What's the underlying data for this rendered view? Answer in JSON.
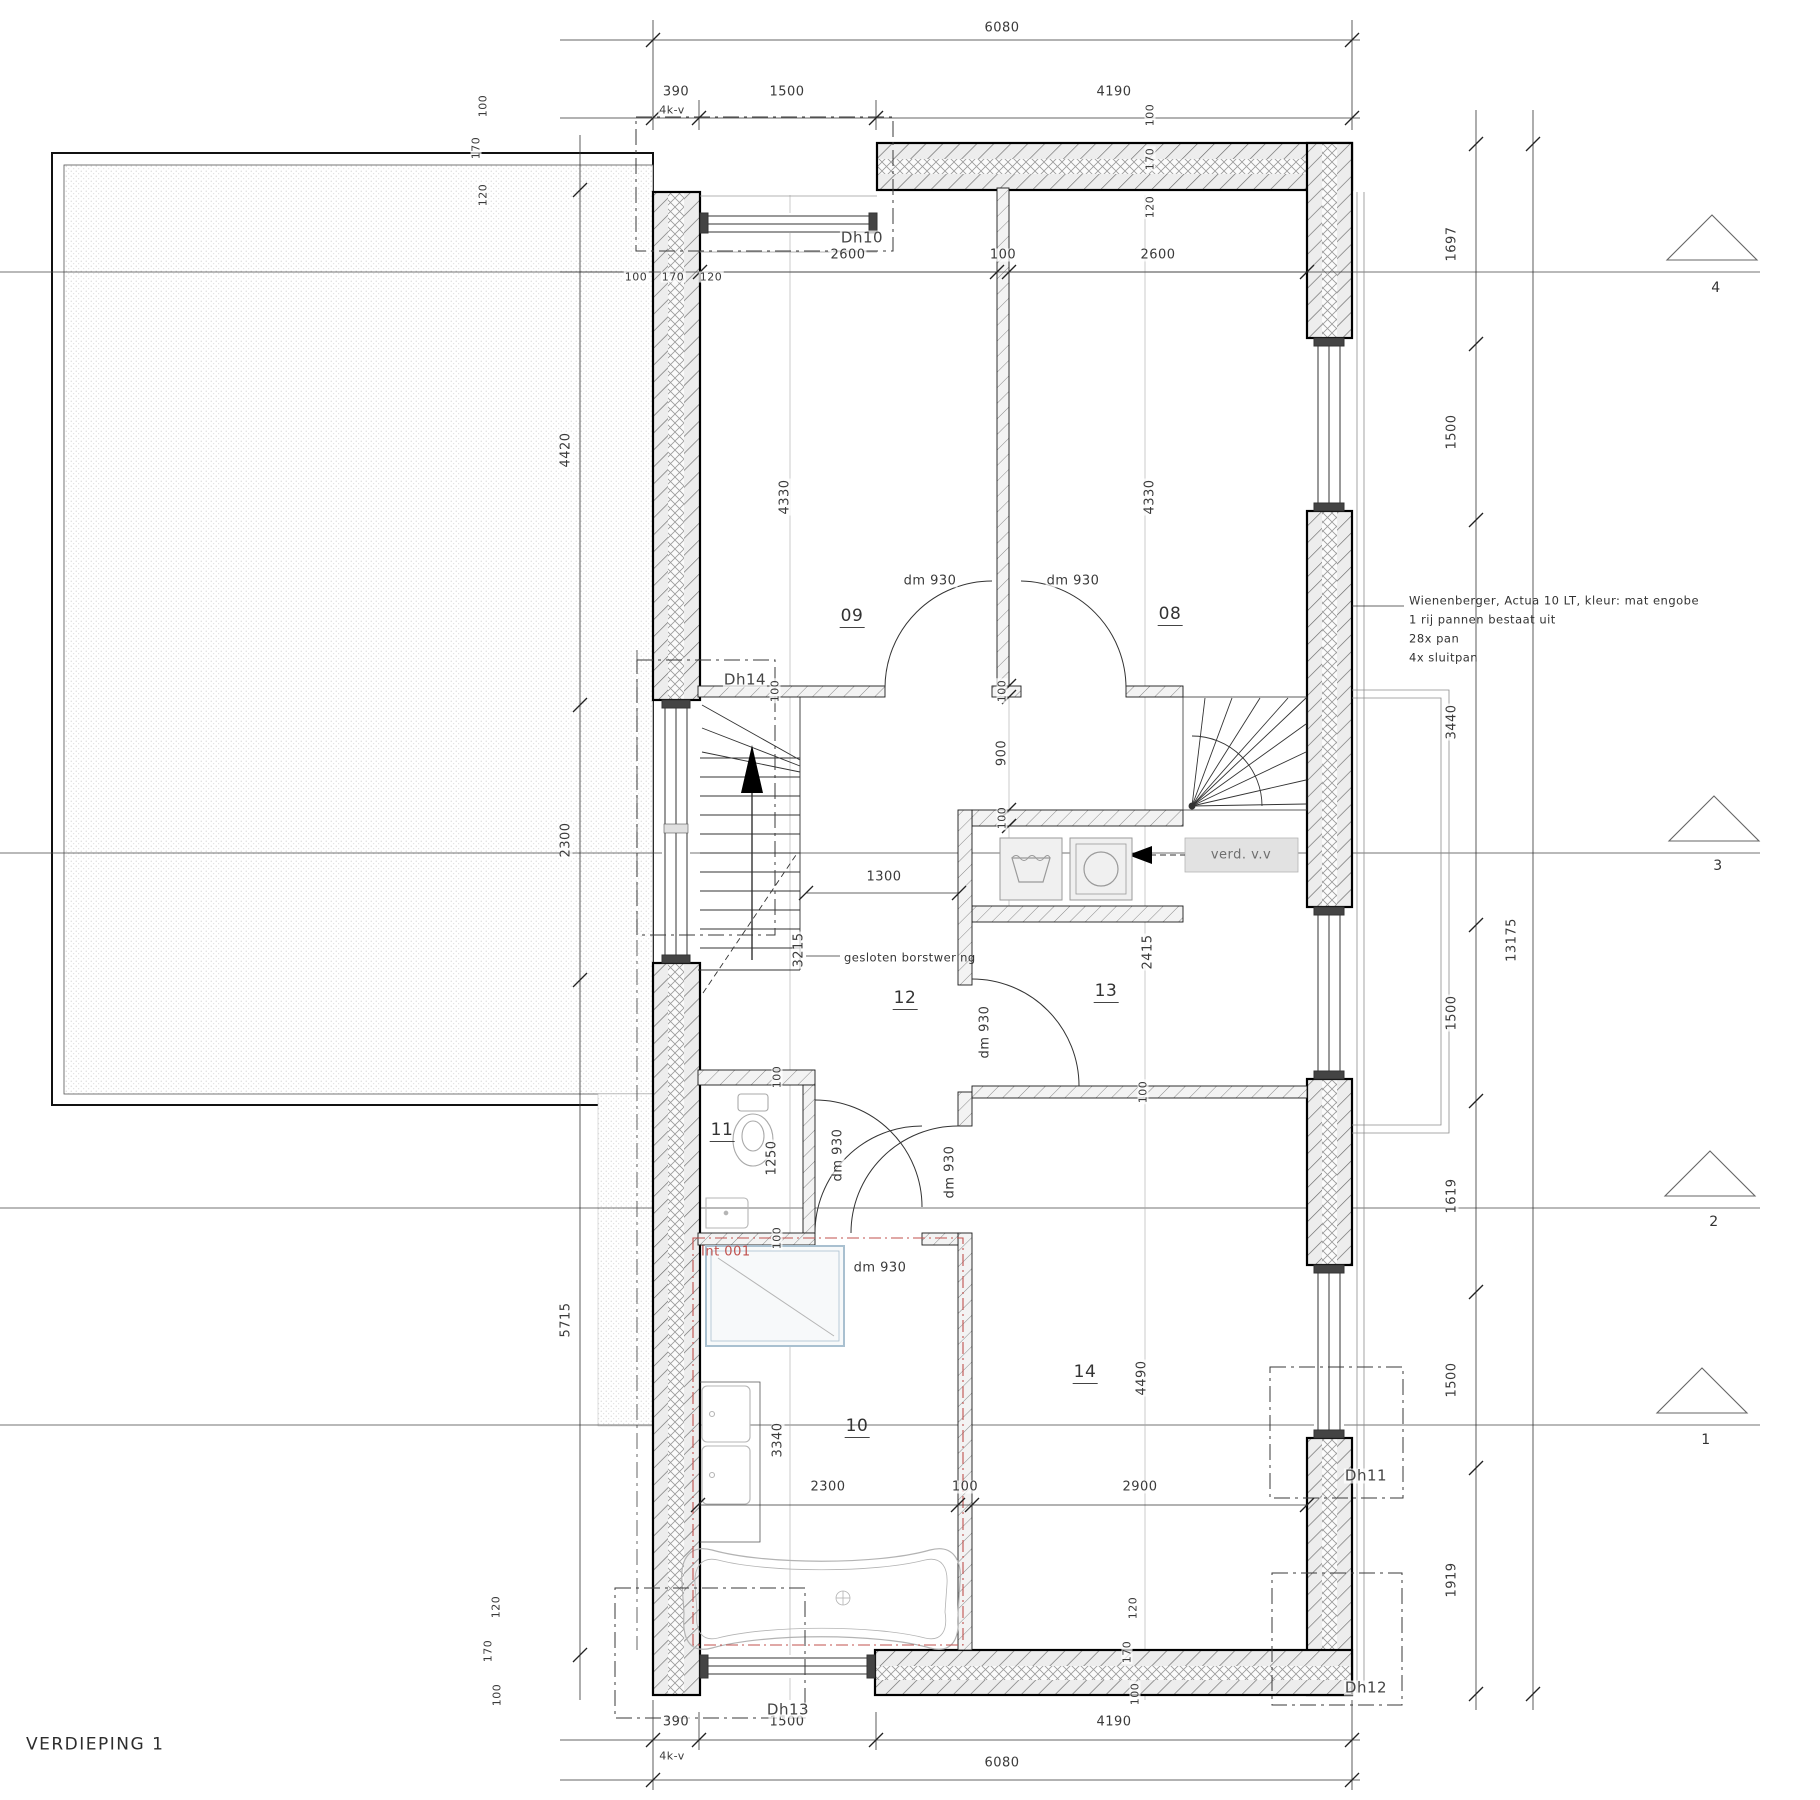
{
  "title": "VERDIEPING 1",
  "rooms": {
    "r08": "08",
    "r09": "09",
    "r10": "10",
    "r11": "11",
    "r12": "12",
    "r13": "13",
    "r14": "14"
  },
  "door_labels": {
    "dh10": "Dh10",
    "dh11": "Dh11",
    "dh12": "Dh12",
    "dh13": "Dh13",
    "dh14": "Dh14",
    "dm930": "dm 930"
  },
  "annotations": {
    "int001": "Int 001",
    "verd_vv": "verd. v.v",
    "borstwering": "gesloten borstwering",
    "kv": "4k-v",
    "roof_note_line1": "Wienenberger, Actua 10 LT, kleur: mat engobe",
    "roof_note_line2": "1 rij pannen bestaat uit",
    "roof_note_line3": "28x pan",
    "roof_note_line4": "4x sluitpan"
  },
  "grid_markers": {
    "g1": "1",
    "g2": "2",
    "g3": "3",
    "g4": "4"
  },
  "dimensions": {
    "v100": "100",
    "v120": "120",
    "v170": "170",
    "v390": "390",
    "v900": "900",
    "v1250": "1250",
    "v1300": "1300",
    "v1500": "1500",
    "v1619": "1619",
    "v1697": "1697",
    "v1919": "1919",
    "v2300": "2300",
    "v2415": "2415",
    "v2600": "2600",
    "v2900": "2900",
    "v3215": "3215",
    "v3340": "3340",
    "v3440": "3440",
    "v4190": "4190",
    "v4330": "4330",
    "v4420": "4420",
    "v4490": "4490",
    "v5715": "5715",
    "v6080": "6080",
    "v13175": "13175"
  },
  "colors": {
    "accent_red": "#c0504d",
    "shower_frame": "#a9c0d0",
    "ink": "#222222",
    "fixture_gray": "#9a9a9a"
  }
}
